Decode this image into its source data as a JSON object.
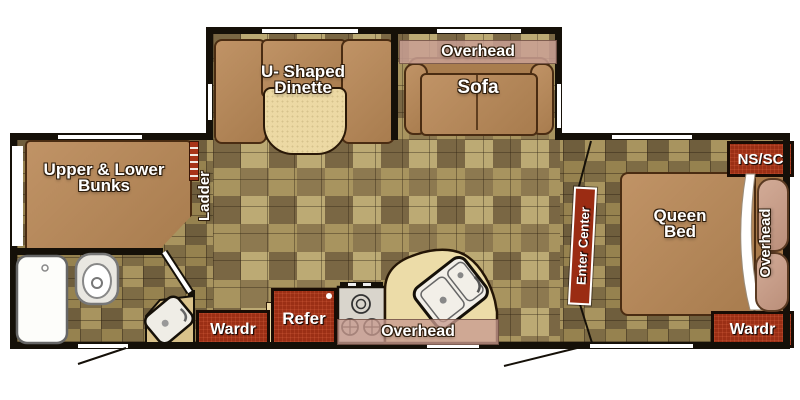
{
  "title": "travel trailer floor plan",
  "labels": {
    "bunks_line1": "Upper & Lower",
    "bunks_line2": "Bunks",
    "ladder": "Ladder",
    "dinette_line1": "U- Shaped",
    "dinette_line2": "Dinette",
    "living_overhead": "Overhead",
    "sofa": "Sofa",
    "kitchen_wardrobe": "Wardr",
    "refrigerator": "Refer",
    "kitchen_overhead": "Overhead",
    "entry_door": "Enter Center",
    "bedroom_nightstand": "NS/SC",
    "bed_line1": "Queen",
    "bed_line2": "Bed",
    "bedroom_overhead": "Overhead",
    "bedroom_wardrobe": "Wardr"
  },
  "colors": {
    "cabinet_red": "#9b2f15",
    "cushion_brown": "#b5885a",
    "counter_cream": "#ecd9a4",
    "overhead_pink": "#c9a094",
    "tile_base": "#9c8a58",
    "wall_black": "#151008"
  },
  "icons": {
    "toilet-icon": "top-view toilet",
    "shower-icon": "shower pan with drain",
    "kitchen-sink-icon": "double-bowl corner sink",
    "bath-sink-icon": "angled lavatory bowl",
    "stove-icon": "three-burner cooktop",
    "ladder-icon": "bunk ladder rungs",
    "pillow-icon": "bed pillows",
    "door-swing-icon": "entry door swing lines"
  }
}
